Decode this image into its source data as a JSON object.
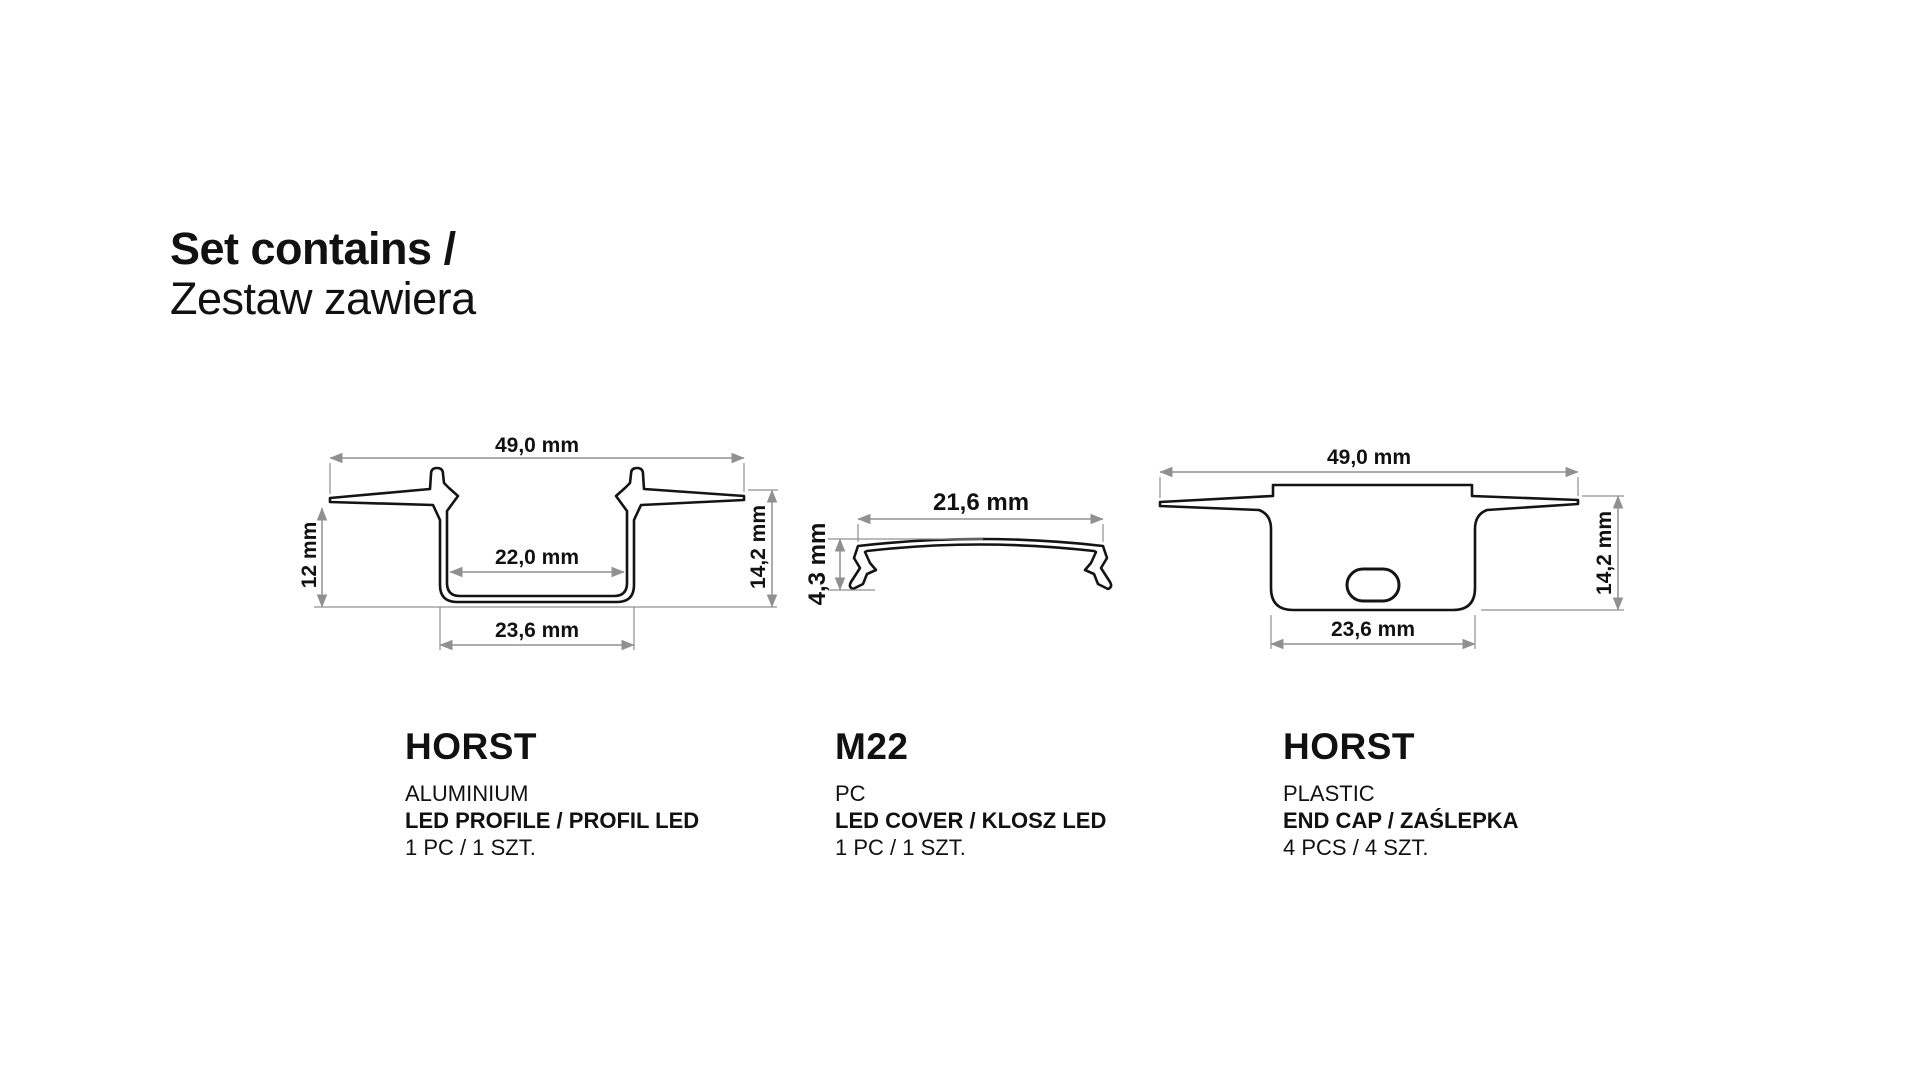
{
  "title": {
    "line1": "Set contains /",
    "line2": "Zestaw zawiera"
  },
  "items": [
    {
      "name": "HORST",
      "material": "ALUMINIUM",
      "type": "LED PROFILE / PROFIL LED",
      "quantity": "1 PC / 1 SZT.",
      "dimensions": {
        "width": "49,0 mm",
        "depth": "12 mm",
        "inner_width": "22,0 mm",
        "bottom_width": "23,6 mm",
        "height": "14,2 mm"
      }
    },
    {
      "name": "M22",
      "material": "PC",
      "type": "LED COVER / KLOSZ LED",
      "quantity": "1 PC / 1 SZT.",
      "dimensions": {
        "width": "21,6 mm",
        "height": "4,3 mm"
      }
    },
    {
      "name": "HORST",
      "material": "PLASTIC",
      "type": "END CAP / ZAŚLEPKA",
      "quantity": "4 PCS / 4 SZT.",
      "dimensions": {
        "width": "49,0 mm",
        "bottom_width": "23,6 mm",
        "height": "14,2 mm"
      }
    }
  ],
  "colors": {
    "background": "#ffffff",
    "outline": "#141414",
    "dimension_line": "#909090",
    "text": "#111111"
  }
}
